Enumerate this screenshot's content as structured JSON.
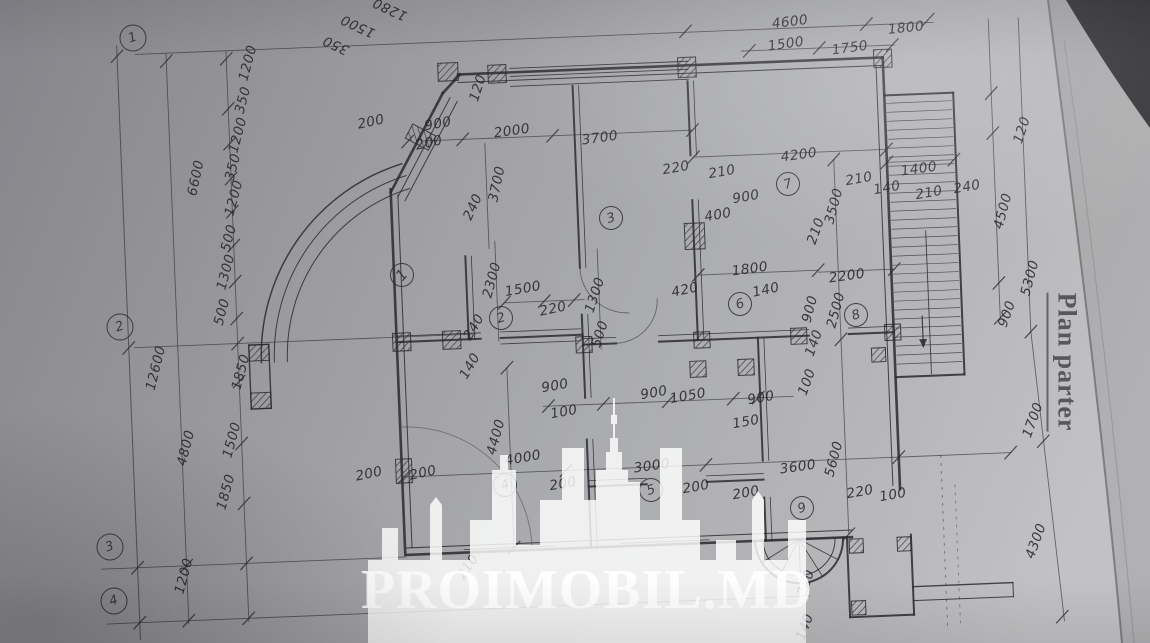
{
  "title": {
    "text": "Plan parter"
  },
  "watermark": {
    "text": "PROIMOBIL.MD"
  },
  "ink": "#2a2a2f",
  "axis_markers": [
    {
      "label": "1",
      "x": 133,
      "y": 38
    },
    {
      "label": "2",
      "x": 120,
      "y": 327
    },
    {
      "label": "3",
      "x": 110,
      "y": 547
    },
    {
      "label": "4",
      "x": 114,
      "y": 601
    }
  ],
  "room_markers": [
    {
      "label": "1",
      "x": 402,
      "y": 275,
      "slash": true
    },
    {
      "label": "2",
      "x": 501,
      "y": 318
    },
    {
      "label": "3",
      "x": 611,
      "y": 218
    },
    {
      "label": "4",
      "x": 505,
      "y": 485
    },
    {
      "label": "5",
      "x": 651,
      "y": 490
    },
    {
      "label": "6",
      "x": 740,
      "y": 304
    },
    {
      "label": "7",
      "x": 788,
      "y": 184
    },
    {
      "label": "8",
      "x": 856,
      "y": 315
    },
    {
      "label": "9",
      "x": 802,
      "y": 508
    }
  ],
  "dim_labels": [
    {
      "t": "4600",
      "x": 790,
      "y": 22,
      "r": -7
    },
    {
      "t": "1500",
      "x": 786,
      "y": 44,
      "r": -8
    },
    {
      "t": "1750",
      "x": 850,
      "y": 48,
      "r": -8
    },
    {
      "t": "1800",
      "x": 906,
      "y": 28,
      "r": -6
    },
    {
      "t": "350",
      "x": 336,
      "y": 45,
      "r": 205
    },
    {
      "t": "1500",
      "x": 358,
      "y": 26,
      "r": 205
    },
    {
      "t": "1280",
      "x": 390,
      "y": 9,
      "r": 205
    },
    {
      "t": "1200",
      "x": 248,
      "y": 63,
      "r": -75
    },
    {
      "t": "350",
      "x": 243,
      "y": 100,
      "r": -75
    },
    {
      "t": "1200",
      "x": 238,
      "y": 135,
      "r": -75
    },
    {
      "t": "350",
      "x": 233,
      "y": 167,
      "r": -75
    },
    {
      "t": "1200",
      "x": 234,
      "y": 198,
      "r": -75
    },
    {
      "t": "500",
      "x": 229,
      "y": 238,
      "r": -75
    },
    {
      "t": "1300",
      "x": 226,
      "y": 272,
      "r": -75
    },
    {
      "t": "500",
      "x": 222,
      "y": 312,
      "r": -75
    },
    {
      "t": "1850",
      "x": 241,
      "y": 372,
      "r": -75
    },
    {
      "t": "1500",
      "x": 232,
      "y": 440,
      "r": -75
    },
    {
      "t": "1850",
      "x": 226,
      "y": 492,
      "r": -75
    },
    {
      "t": "1200",
      "x": 184,
      "y": 576,
      "r": -75
    },
    {
      "t": "6600",
      "x": 196,
      "y": 178,
      "r": -78
    },
    {
      "t": "12600",
      "x": 156,
      "y": 368,
      "r": -76
    },
    {
      "t": "4800",
      "x": 186,
      "y": 448,
      "r": -76
    },
    {
      "t": "200",
      "x": 371,
      "y": 122,
      "r": -12
    },
    {
      "t": "900",
      "x": 438,
      "y": 124,
      "r": -10
    },
    {
      "t": "2000",
      "x": 512,
      "y": 131,
      "r": -8
    },
    {
      "t": "3700",
      "x": 600,
      "y": 138,
      "r": -8
    },
    {
      "t": "3700",
      "x": 497,
      "y": 184,
      "r": -78
    },
    {
      "t": "200",
      "x": 429,
      "y": 143,
      "r": -12
    },
    {
      "t": "120",
      "x": 478,
      "y": 88,
      "r": -72
    },
    {
      "t": "240",
      "x": 473,
      "y": 207,
      "r": -65
    },
    {
      "t": "2300",
      "x": 492,
      "y": 280,
      "r": -75
    },
    {
      "t": "1500",
      "x": 523,
      "y": 289,
      "r": -10
    },
    {
      "t": "220",
      "x": 553,
      "y": 309,
      "r": -12
    },
    {
      "t": "240",
      "x": 474,
      "y": 327,
      "r": -60
    },
    {
      "t": "140",
      "x": 470,
      "y": 366,
      "r": -60
    },
    {
      "t": "1300",
      "x": 595,
      "y": 295,
      "r": -72
    },
    {
      "t": "500",
      "x": 600,
      "y": 334,
      "r": -72
    },
    {
      "t": "900",
      "x": 555,
      "y": 386,
      "r": -10
    },
    {
      "t": "100",
      "x": 564,
      "y": 412,
      "r": -10
    },
    {
      "t": "220",
      "x": 676,
      "y": 168,
      "r": -10
    },
    {
      "t": "210",
      "x": 722,
      "y": 172,
      "r": -10
    },
    {
      "t": "4200",
      "x": 799,
      "y": 155,
      "r": -8
    },
    {
      "t": "210",
      "x": 859,
      "y": 179,
      "r": -10
    },
    {
      "t": "140",
      "x": 887,
      "y": 188,
      "r": -10
    },
    {
      "t": "900",
      "x": 746,
      "y": 197,
      "r": -10
    },
    {
      "t": "400",
      "x": 718,
      "y": 215,
      "r": -10
    },
    {
      "t": "3500",
      "x": 834,
      "y": 206,
      "r": -75
    },
    {
      "t": "210",
      "x": 816,
      "y": 231,
      "r": -70
    },
    {
      "t": "1800",
      "x": 750,
      "y": 269,
      "r": -8
    },
    {
      "t": "2200",
      "x": 847,
      "y": 276,
      "r": -8
    },
    {
      "t": "420",
      "x": 685,
      "y": 290,
      "r": -12
    },
    {
      "t": "140",
      "x": 766,
      "y": 290,
      "r": -12
    },
    {
      "t": "2500",
      "x": 836,
      "y": 310,
      "r": -75
    },
    {
      "t": "900",
      "x": 810,
      "y": 309,
      "r": -75
    },
    {
      "t": "140",
      "x": 814,
      "y": 343,
      "r": -70
    },
    {
      "t": "100",
      "x": 807,
      "y": 382,
      "r": -70
    },
    {
      "t": "1400",
      "x": 919,
      "y": 169,
      "r": -8
    },
    {
      "t": "210",
      "x": 929,
      "y": 193,
      "r": -10
    },
    {
      "t": "240",
      "x": 967,
      "y": 187,
      "r": -10
    },
    {
      "t": "120",
      "x": 1022,
      "y": 130,
      "r": -72
    },
    {
      "t": "4500",
      "x": 1003,
      "y": 211,
      "r": -75
    },
    {
      "t": "5300",
      "x": 1030,
      "y": 278,
      "r": -75
    },
    {
      "t": "900",
      "x": 1007,
      "y": 314,
      "r": -70
    },
    {
      "t": "1700",
      "x": 1033,
      "y": 420,
      "r": -70
    },
    {
      "t": "4300",
      "x": 1036,
      "y": 541,
      "r": -70
    },
    {
      "t": "900",
      "x": 654,
      "y": 393,
      "r": -10
    },
    {
      "t": "1050",
      "x": 688,
      "y": 396,
      "r": -10
    },
    {
      "t": "900",
      "x": 761,
      "y": 398,
      "r": -10
    },
    {
      "t": "150",
      "x": 746,
      "y": 422,
      "r": -10
    },
    {
      "t": "4400",
      "x": 496,
      "y": 437,
      "r": -75
    },
    {
      "t": "4000",
      "x": 523,
      "y": 458,
      "r": -10
    },
    {
      "t": "3000",
      "x": 652,
      "y": 466,
      "r": -8
    },
    {
      "t": "3600",
      "x": 798,
      "y": 467,
      "r": -8
    },
    {
      "t": "5600",
      "x": 834,
      "y": 459,
      "r": -75
    },
    {
      "t": "200",
      "x": 563,
      "y": 484,
      "r": -10
    },
    {
      "t": "200",
      "x": 696,
      "y": 487,
      "r": -10
    },
    {
      "t": "200",
      "x": 746,
      "y": 493,
      "r": -10
    },
    {
      "t": "220",
      "x": 860,
      "y": 492,
      "r": -10
    },
    {
      "t": "100",
      "x": 893,
      "y": 495,
      "r": -10
    },
    {
      "t": "200",
      "x": 369,
      "y": 474,
      "r": -12
    },
    {
      "t": "200",
      "x": 423,
      "y": 473,
      "r": -12
    },
    {
      "t": "210",
      "x": 468,
      "y": 567,
      "r": -55
    },
    {
      "t": "220",
      "x": 806,
      "y": 583,
      "r": -70
    },
    {
      "t": "140",
      "x": 805,
      "y": 627,
      "r": -70
    }
  ]
}
